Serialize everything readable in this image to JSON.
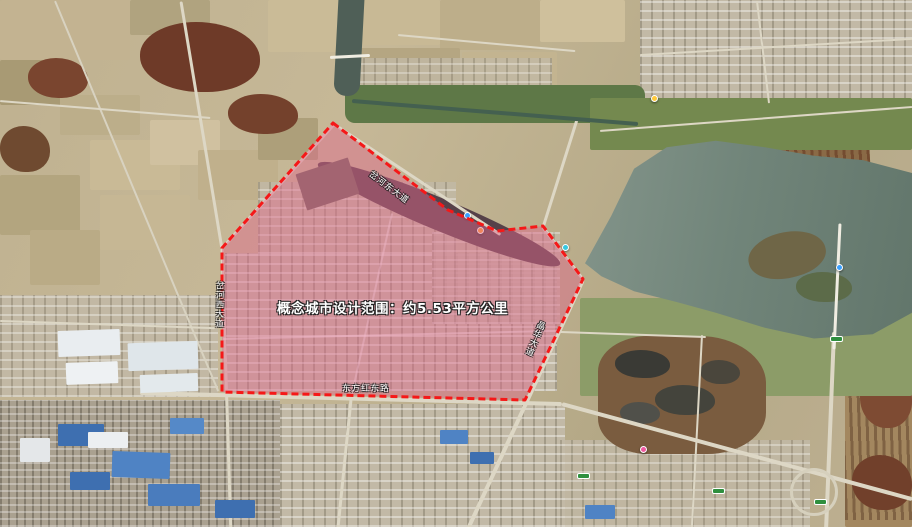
{
  "map": {
    "annotation": {
      "label": "概念城市设计范围：约5.53平方公里",
      "area_text": "约5.53平方公里",
      "boundary_points": "333,123 448,210 497,231 543,226 583,279 525,400 222,392 222,248",
      "boundary_color": "#f51818",
      "fill_color": "rgba(223,105,140,0.47)"
    },
    "road_labels": [
      {
        "text": "岔河西大道"
      },
      {
        "text": "岔河东大道"
      },
      {
        "text": "晶华大道"
      },
      {
        "text": "东方红东路"
      }
    ],
    "markers": [
      {
        "x": 464,
        "y": 212,
        "color": "#3aa0ff",
        "type": "dot",
        "name": "poi-marker-blue"
      },
      {
        "x": 477,
        "y": 227,
        "color": "#ff9d2e",
        "type": "dot",
        "name": "poi-marker-orange"
      },
      {
        "x": 562,
        "y": 244,
        "color": "#36c8e0",
        "type": "dot",
        "name": "poi-marker-cyan"
      },
      {
        "x": 651,
        "y": 95,
        "color": "#ffc93a",
        "type": "dot",
        "name": "poi-marker-yellow"
      },
      {
        "x": 836,
        "y": 264,
        "color": "#3aa0ff",
        "type": "dot",
        "name": "poi-marker-bridge"
      },
      {
        "x": 640,
        "y": 446,
        "color": "#f05aa0",
        "type": "dot",
        "name": "poi-marker-pink"
      },
      {
        "x": 712,
        "y": 488,
        "color": "#2f8f3e",
        "type": "pill",
        "name": "expressway-shield"
      },
      {
        "x": 814,
        "y": 499,
        "color": "#2f8f3e",
        "type": "pill",
        "name": "expressway-shield"
      },
      {
        "x": 830,
        "y": 336,
        "color": "#2f8f3e",
        "type": "pill",
        "name": "expressway-shield"
      },
      {
        "x": 577,
        "y": 473,
        "color": "#2f8f3e",
        "type": "pill",
        "name": "expressway-shield"
      }
    ]
  }
}
